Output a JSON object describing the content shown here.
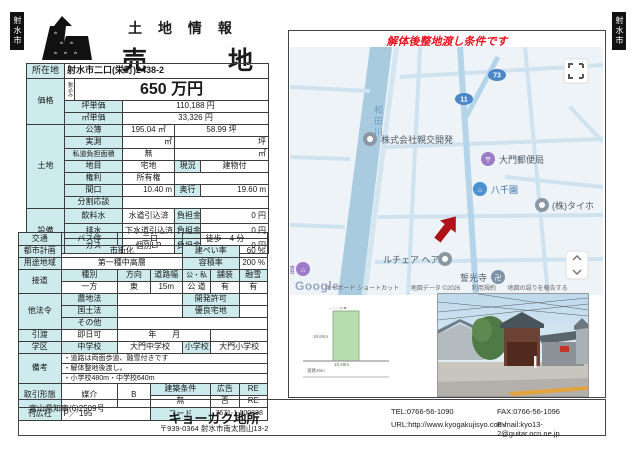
{
  "badges": {
    "text": "射水市"
  },
  "header": {
    "category": "土 地 情 報",
    "title": "売　地"
  },
  "notice": "解体後整地渡し条件です",
  "info": {
    "location": {
      "label": "所在地",
      "value": "射水市二口(栄町)2438-2"
    },
    "price": {
      "label": "価格",
      "tax_note": "税込み",
      "amount": "650 万円",
      "tsubo_label": "坪単価",
      "tsubo": "110,188 円",
      "sqm_label": "㎡単価",
      "sqm": "33,326 円"
    },
    "land": {
      "label": "土地",
      "koubo": {
        "label": "公簿",
        "sqm": "195.04 ㎡",
        "tsubo": "58.99 坪"
      },
      "jissoku": {
        "label": "実測",
        "sqm": "㎡",
        "tsubo": "坪"
      },
      "shido": {
        "label": "私道負担面積",
        "value": "無",
        "unit": "㎡"
      },
      "chimoku": {
        "label": "地目",
        "value": "宅地",
        "genkyo_label": "現況",
        "genkyo": "建物付"
      },
      "kenri": {
        "label": "権利",
        "value": "所有権"
      },
      "maguchi": {
        "label": "間口",
        "value": "10.40 m",
        "okuyuki_label": "奥行",
        "okuyuki": "19.60 m"
      },
      "bunkatsu": {
        "label": "分割応談"
      }
    },
    "setsubi": {
      "label": "設備",
      "rows": [
        {
          "label": "飲料水",
          "value": "水道引込済",
          "fee_label": "負担金",
          "fee": "0 円"
        },
        {
          "label": "排水",
          "value": "下水道引込済",
          "fee_label": "負担金",
          "fee": "0 円"
        },
        {
          "label": "ガス",
          "value": "個別LP",
          "fee_label": "負担金",
          "fee": "0 円"
        }
      ]
    }
  },
  "detail": {
    "kotsu": {
      "label": "交通",
      "v1": "バス停",
      "v2": "二口",
      "v3": "徒歩　4 分"
    },
    "toshi": {
      "label": "都市計画",
      "value": "市街化",
      "kenpei_label": "建ぺい率",
      "kenpei": "60 %"
    },
    "yoto": {
      "label": "用途地域",
      "value": "第一種中高層",
      "yoseki_label": "容積率",
      "yoseki": "200 %"
    },
    "setsudo": {
      "label": "接道",
      "h1": "種別",
      "h2": "方向",
      "h3": "道路幅",
      "h4": "公・私",
      "h5": "舗装",
      "h6": "融雪",
      "v1": "一方",
      "v2": "東",
      "v3": "15m",
      "v4": "公 道",
      "v5": "有",
      "v6": "有"
    },
    "horei": {
      "label": "他法令",
      "r1l": "農地法",
      "r1m": "開発許可",
      "r2l": "国土法",
      "r2m": "優良宅地",
      "r3l": "その他"
    },
    "hikiwatashi": {
      "label": "引渡",
      "value": "即日可",
      "date": "年　　月"
    },
    "gakku": {
      "label": "学区",
      "chu_label": "中学校",
      "chu": "大門中学校",
      "sho_label": "小学校",
      "sho": "大門小学校"
    },
    "biko": {
      "label": "備考",
      "lines": [
        "・道路は両面歩道、融雪付きです",
        "・解体整地後渡し。",
        "・小学校480m・中学校640m"
      ]
    },
    "torihiki": {
      "label": "取引形態",
      "value": "媒介",
      "code": "B",
      "kenchiku_label": "建築条件",
      "kenchiku": "無",
      "kokoku_label": "広告",
      "kokoku": "否",
      "re_label": "RE",
      "re": "RE"
    },
    "kankosha": {
      "label": "刊広社",
      "value": "P／ 195",
      "code_label": "コード",
      "code": "7671-1-000338"
    }
  },
  "map": {
    "river": "和田川",
    "routes": [
      "73",
      "11"
    ],
    "pois": [
      {
        "name": "株式会社親交開発"
      },
      {
        "name": "大門郵便局"
      },
      {
        "name": "八千園"
      },
      {
        "name": "(株)タイホ"
      },
      {
        "name": "公民館"
      },
      {
        "name": "ルチェア ヘア"
      },
      {
        "name": "誓光寺"
      }
    ],
    "google": "Google",
    "attribution": {
      "k1": "キーボード ショートカット",
      "k2": "地図データ ©2026",
      "k3": "利用規約",
      "k4": "地図の誤りを報告する"
    },
    "colors": {
      "accent_red": "#b0121a",
      "route_blue": "#4a86c8",
      "river_blue": "#a9cbdf"
    }
  },
  "diagram": {
    "side": "19.60m",
    "front": "10.40m",
    "road": "道路15m"
  },
  "footer": {
    "license": "富山県知事(6)2509号",
    "company": "キョーガク地所",
    "address": "〒939-0364 射水市南太閤山13-2",
    "tel": "TEL:0766-56-1090",
    "url": "URL:http://www.kyogakujisyo.com/",
    "fax": "FAX:0766-56-1096",
    "email": "E-mail:kyo13-2@guitar.ocn.ne.jp"
  }
}
